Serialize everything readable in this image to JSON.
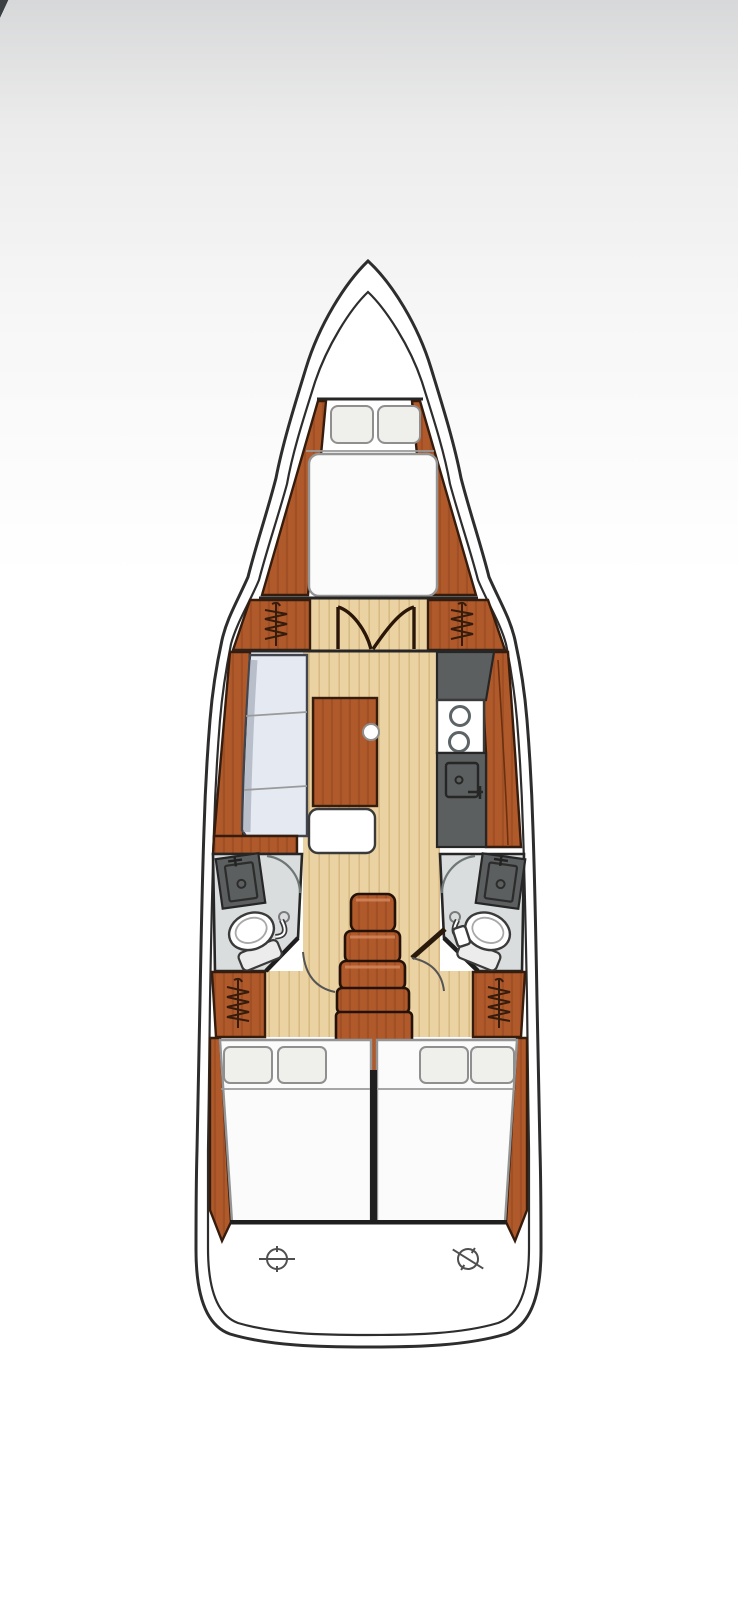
{
  "title": "Sailboat interior layout plan (top view)",
  "colors": {
    "page_top": "#d7d8d9",
    "page_bottom": "#ffffff",
    "corner_mark": "#3c4043",
    "hull_fill": "#ffffff",
    "hull_line": "#2d2d2d",
    "wood": "#b05a2b",
    "wood_dark": "#8a421f",
    "wood_outline": "#361c0c",
    "wood_highlight": "#d2855a",
    "floor": "#ead2a2",
    "floor_streak": "#d8bb84",
    "sofa": "#e4e9f2",
    "sofa_shade": "#b3bac7",
    "mattress": "#fbfbfb",
    "pillow": "#efefec",
    "counter": "#5c5f5f",
    "bath_floor": "#d9dddd",
    "outline_dark": "#262626"
  },
  "areas": {
    "anchor_locker": "bow locker",
    "forward_cabin": "V-berth double bed with two pillows and side wardrobes",
    "salon": "L-shaped settee port side with saloon table",
    "galley": "starboard counters with two-burner stove and sink",
    "head_port": "port bathroom with basin and toilet",
    "head_starboard": "starboard bathroom with basin and toilet",
    "companionway": "five wooden steps down the centerline",
    "aft_cabin_port": "double berth with two pillows",
    "aft_cabin_starboard": "double berth with two pillows",
    "transom": "stern platform with two deck fittings"
  },
  "icons": [
    "hanger-icon",
    "door-swing-icon",
    "double-door-icon",
    "burner-icon",
    "sink-icon",
    "toilet-icon",
    "deck-fitting-icon"
  ]
}
